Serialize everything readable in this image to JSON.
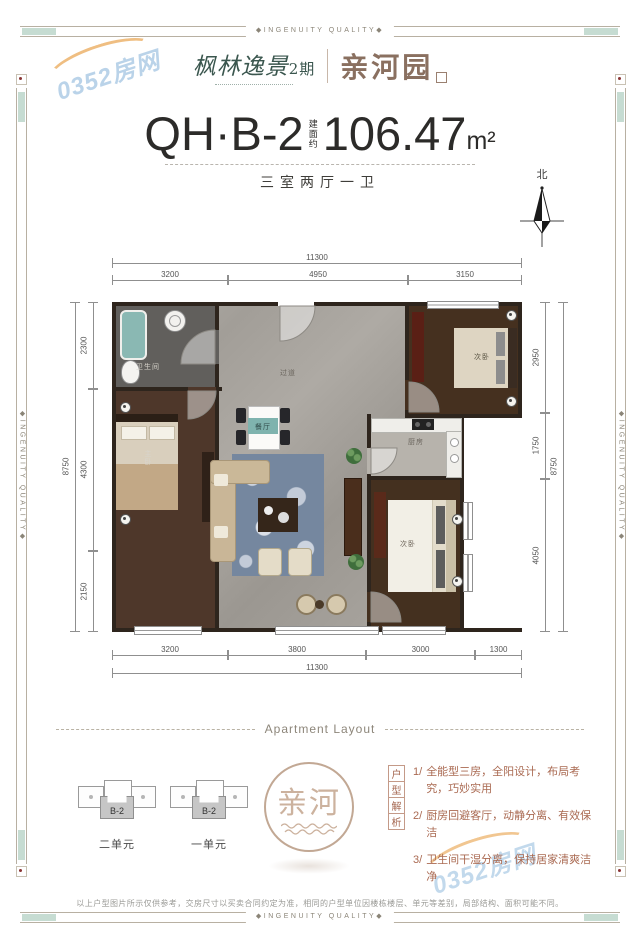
{
  "frame": {
    "band_text": "◆INGENUITY QUALITY◆"
  },
  "watermark": {
    "text": "0352房网"
  },
  "header": {
    "brand": "枫林逸景",
    "brand_phase": "2期",
    "project": "亲河园"
  },
  "title": {
    "unit_code": "QH·B-2",
    "area_label": "建面约",
    "area_value": "106.47",
    "area_unit": "m²",
    "rooms_desc": "三室两厅一卫"
  },
  "compass": {
    "north": "北"
  },
  "plan": {
    "rooms": {
      "bathroom": "卫生间",
      "master": "主卧",
      "hall": "过道",
      "dining": "餐厅",
      "kitchen": "厨房",
      "bedroom2": "次卧",
      "bedroom3": "次卧"
    },
    "dims": {
      "top_total": "11300",
      "top_segments": [
        "3200",
        "4950",
        "3150"
      ],
      "bottom_segments": [
        "3200",
        "3800",
        "3000",
        "1300"
      ],
      "bottom_total": "11300",
      "left_total": "8750",
      "left_segments": [
        "2300",
        "4300",
        "2150"
      ],
      "right_segments": [
        "2950",
        "1750",
        "4050"
      ],
      "right_total": "8750"
    }
  },
  "divider": {
    "label": "Apartment Layout"
  },
  "keyplan": {
    "units": [
      {
        "code": "B-2",
        "name": "二单元"
      },
      {
        "code": "B-2",
        "name": "一单元"
      }
    ]
  },
  "seal": {
    "char1": "亲",
    "char2": "河"
  },
  "analysis": {
    "heading_chars": [
      "户",
      "型",
      "解",
      "析"
    ],
    "points": [
      {
        "num": "1/",
        "text": "全能型三房，全阳设计，布局考究，巧妙实用"
      },
      {
        "num": "2/",
        "text": "厨房回避客厅，动静分离、有效保洁"
      },
      {
        "num": "3/",
        "text": "卫生间干湿分离，保持居家清爽洁净"
      }
    ]
  },
  "disclaimer": "以上户型图片所示仅供参考，交房尺寸以买卖合同约定为准，相同的户型单位因楼栋楼层、单元等差别，局部结构、面积可能不同。"
}
